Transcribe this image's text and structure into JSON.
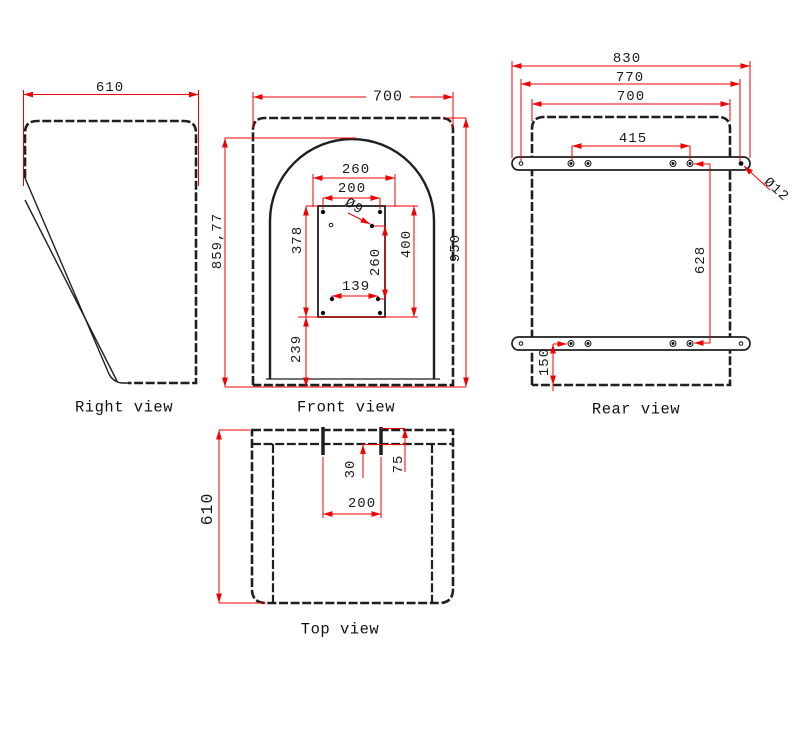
{
  "views": {
    "right": {
      "label": "Right view",
      "dims": {
        "width": "610"
      }
    },
    "front": {
      "label": "Front view",
      "dims": {
        "width": "700",
        "arch_height": "859,77",
        "total_height": "950",
        "plate_width": "260",
        "top_hole_span": "200",
        "hole_dia": "Ø9",
        "left_height": "378",
        "right_height": "400",
        "mid_hole_span": "260",
        "bottom_hole_span": "139",
        "bottom_offset": "239"
      }
    },
    "rear": {
      "label": "Rear view",
      "dims": {
        "overall_width": "830",
        "end_hole_span": "770",
        "body_width": "700",
        "hole_span": "415",
        "hole_dia": "Ø12",
        "vertical_span": "628",
        "bottom_offset": "150"
      }
    },
    "top": {
      "label": "Top view",
      "dims": {
        "depth": "610",
        "slot_span": "200",
        "slot_depth": "30",
        "slot_offset": "75"
      }
    }
  },
  "colors": {
    "dimension_lines": "#ff0000",
    "outline": "#1f1f1f",
    "background": "#ffffff"
  }
}
